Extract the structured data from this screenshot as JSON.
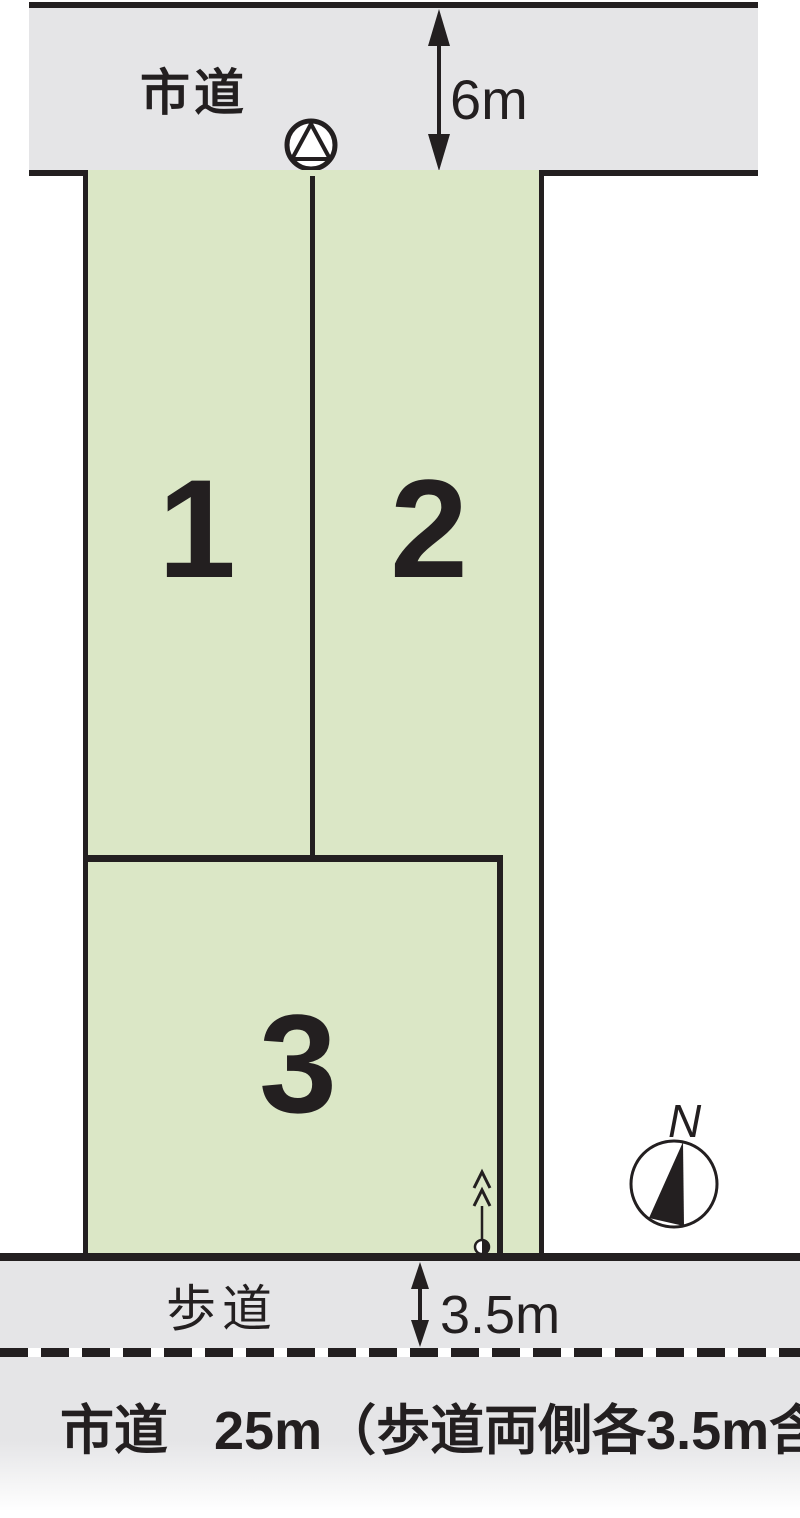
{
  "diagram_type": "land-lot-layout",
  "colors": {
    "line": "#231f20",
    "road": "#e5e5e7",
    "lot": "#dbe7c6",
    "paper": "#ffffff"
  },
  "top_road": {
    "label": "市道",
    "width_label": "6m"
  },
  "lots": [
    {
      "number": "1"
    },
    {
      "number": "2"
    },
    {
      "number": "3"
    }
  ],
  "sidewalk": {
    "label": "歩道",
    "width_label": "3.5m"
  },
  "bottom_road": {
    "name": "市道",
    "spec": "25m（歩道両側各3.5m含）"
  },
  "compass": {
    "north_label": "N"
  },
  "icons": {
    "survey_marker": "circle-with-inscribed-triangle",
    "access_marker": "half-filled-dot-with-up-arrow",
    "dimension_arrows": "double-headed-vertical"
  }
}
